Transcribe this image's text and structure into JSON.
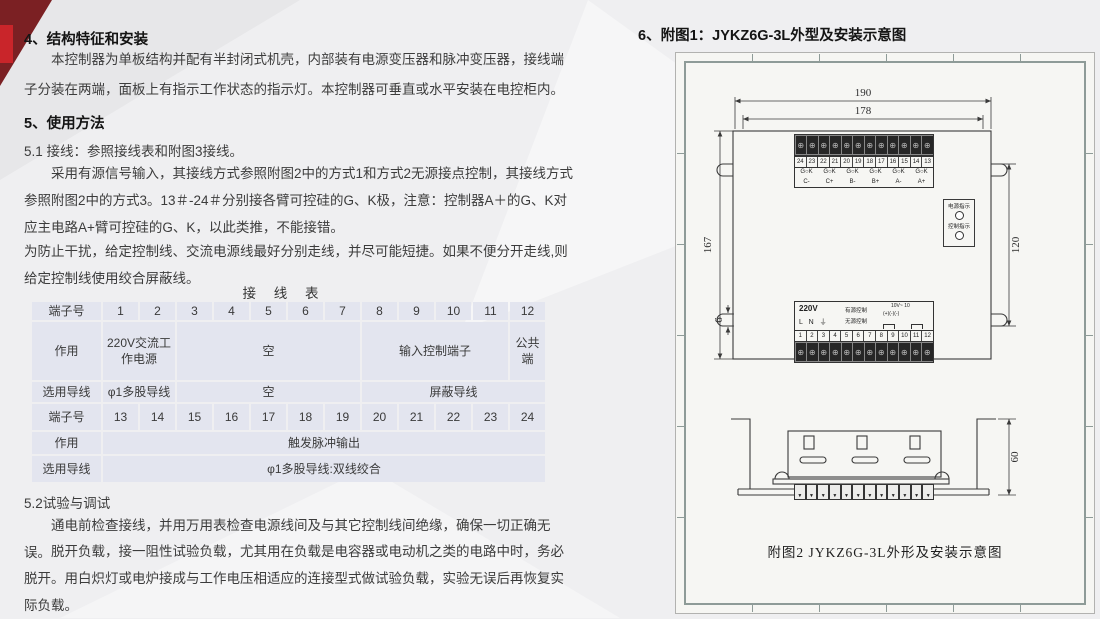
{
  "page": {
    "accent_red": "#c9252a",
    "accent_dark_red": "#7b2023",
    "paper_color": "#f6f6f3",
    "table_cell_color": "#e3e5ef"
  },
  "left": {
    "section4_title": "4、结构特征和安装",
    "section4_para": "本控制器为单板结构并配有半封闭式机壳，内部装有电源变压器和脉冲变压器，接线端子分装在两端，面板上有指示工作状态的指示灯。本控制器可垂直或水平安装在电控柜内。",
    "section5_title": "5、使用方法",
    "s51_line": "5.1 接线：参照接线表和附图3接线。",
    "s51_para1": "采用有源信号输入，其接线方式参照附图2中的方式1和方式2无源接点控制，其接线方式参照附图2中的方式3。13＃-24＃分别接各臂可控硅的G、K极，注意：控制器A＋的G、K对应主电路A+臂可控硅的G、K，以此类推，不能接错。",
    "s51_para2": "为防止干扰，给定控制线、交流电源线最好分别走线，并尽可能短捷。如果不便分开走线,则给定控制线使用绞合屏蔽线。",
    "table_title": "接 线 表",
    "table": {
      "header_terminal": "端子号",
      "header_action": "作用",
      "header_wire": "选用导线",
      "terminals_1_12": [
        "1",
        "2",
        "3",
        "4",
        "5",
        "6",
        "7",
        "8",
        "9",
        "10",
        "11",
        "12"
      ],
      "terminals_13_24": [
        "13",
        "14",
        "15",
        "16",
        "17",
        "18",
        "19",
        "20",
        "21",
        "22",
        "23",
        "24"
      ],
      "cell_power": "220V交流工作电源",
      "cell_empty1": "空",
      "cell_input": "输入控制端子",
      "cell_common": "公共端",
      "cell_wire1": "φ1多股导线",
      "cell_empty2": "空",
      "cell_shield": "屏蔽导线",
      "cell_trigger": "触发脉冲输出",
      "cell_wire2": "φ1多股导线:双线绞合"
    },
    "s52_title": "5.2试验与调试",
    "s52_para1": "通电前检查接线，并用万用表检查电源线间及与其它控制线间绝缘，确保一切正确无误。",
    "s52_para2": "脱开负载，接一阻性试验负载，尤其用在负载是电容器或电动机之类的电路中时，务必脱开。用白炽灯或电炉接成与工作电压相适应的连接型式做试验负载，实验无误后再恢复实际负载。"
  },
  "right": {
    "title": "6、附图1：JYKZ6G-3L外型及安装示意图",
    "diagram": {
      "dim_width_outer": "190",
      "dim_width_inner": "178",
      "dim_height_left": "167",
      "dim_height_right": "120",
      "dim_gap": "6",
      "dim_depth": "60",
      "top_terminals": [
        "24",
        "23",
        "22",
        "21",
        "20",
        "19",
        "18",
        "17",
        "16",
        "15",
        "14",
        "13"
      ],
      "gok_groups": [
        "G○K\nC-",
        "G○K\nC+",
        "G○K\nB-",
        "G○K\nB+",
        "G○K\nA-",
        "G○K\nA+"
      ],
      "screw_row": [
        "⊕",
        "⊕",
        "⊕",
        "⊕",
        "⊕",
        "⊕",
        "⊕",
        "⊕",
        "⊕",
        "⊕",
        "⊕",
        "⊕"
      ],
      "teeth_row": [
        "▼",
        "▼",
        "▼",
        "▼",
        "▼",
        "▼",
        "▼",
        "▼",
        "▼",
        "▼",
        "▼",
        "▼"
      ],
      "power_led_label": "电源指示",
      "control_led_label": "控制指示",
      "supply_label": "220V",
      "supply_pins": "L N ⏚",
      "active_label": "有源控制",
      "passive_label": "无源控制",
      "volt_note": "10V~ 10",
      "polarity_note": "(+)(-)(-)",
      "bottom_terminals": [
        "1",
        "2",
        "3",
        "4",
        "5",
        "6",
        "7",
        "8",
        "9",
        "10",
        "11",
        "12"
      ],
      "caption": "附图2 JYKZ6G-3L外形及安装示意图"
    }
  }
}
